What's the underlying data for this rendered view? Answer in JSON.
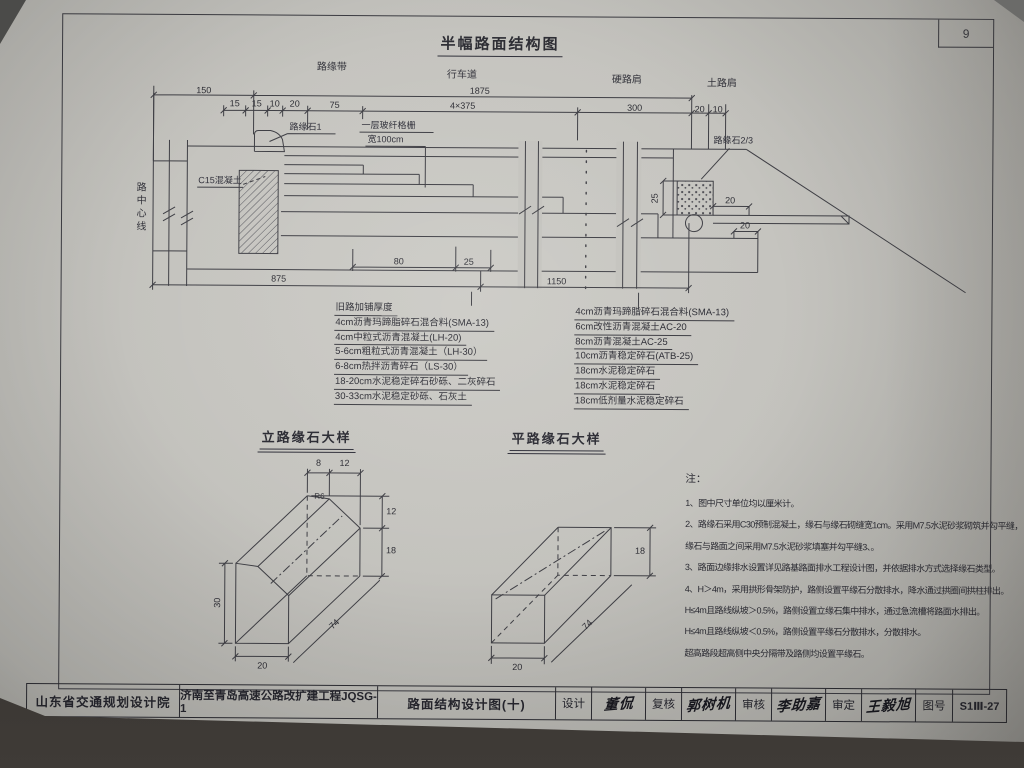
{
  "page": {
    "number": "9"
  },
  "drawing": {
    "title": "半幅路面结构图"
  },
  "cross_section": {
    "zone_labels": [
      "路缘带",
      "行车道",
      "硬路肩",
      "土路肩"
    ],
    "dims_top1": [
      "150",
      "1875"
    ],
    "dims_top2": [
      "15",
      "15",
      "10",
      "20",
      "75",
      "4×375",
      "300",
      "20",
      "10"
    ],
    "labels": {
      "curb1": "路缘石1",
      "geogrid1": "一层玻纤格栅",
      "geogrid2": "宽100cm",
      "concrete": "C15混凝土",
      "road_centerline": "路中心线",
      "curb23": "路缘石2/3"
    },
    "dims_inner": {
      "w80": "80",
      "w25": "25",
      "w875": "875",
      "w1150": "1150",
      "h25": "25",
      "w20_shoulder": "20",
      "w20_step": "20"
    }
  },
  "layer_lists": {
    "left": [
      "旧路加铺厚度",
      "4cm沥青玛蹄脂碎石混合料(SMA-13)",
      "4cm中粒式沥青混凝土(LH-20)",
      "5-6cm粗粒式沥青混凝土（LH-30）",
      "6-8cm热拌沥青碎石（LS-30）",
      "18-20cm水泥稳定碎石砂砾、二灰碎石",
      "30-33cm水泥稳定砂砾、石灰土"
    ],
    "right": [
      "4cm沥青玛蹄脂碎石混合料(SMA-13)",
      "6cm改性沥青混凝土AC-20",
      "8cm沥青混凝土AC-25",
      "10cm沥青稳定碎石(ATB-25)",
      "18cm水泥稳定碎石",
      "18cm水泥稳定碎石",
      "18cm低剂量水泥稳定碎石"
    ]
  },
  "details": {
    "vertical_curb": {
      "title": "立路缘石大样",
      "dims": {
        "top_a": "8",
        "top_b": "12",
        "right_upper": "12",
        "right_lower": "18",
        "height": "30",
        "width": "20",
        "length": "74",
        "fillet": "R6"
      }
    },
    "flat_curb": {
      "title": "平路缘石大样",
      "dims": {
        "height": "18",
        "width": "20",
        "length": "74"
      }
    }
  },
  "notes": {
    "heading": "注：",
    "lines": [
      "1、图中尺寸单位均以厘米计。",
      "2、路缘石采用C30预制混凝土，缘石与缘石砌缝宽1cm。采用M7.5水泥砂浆砌筑并勾平缝，",
      "缘石与路面之间采用M7.5水泥砂浆填塞并勾平缝3、。",
      "3、路面边缘排水设置详见路基路面排水工程设计图，并依据排水方式选择缘石类型。",
      "4、H＞4m，采用拱形骨架防护，路侧设置平缘石分散排水，降水通过拱圈间拱柱排出。",
      "H≤4m且路线纵坡＞0.5%，路侧设置立缘石集中排水，通过急流槽将路面水排出。",
      "H≤4m且路线纵坡＜0.5%，路侧设置平缘石分散排水，分散排水。",
      "超高路段超高侧中央分隔带及路侧均设置平缘石。"
    ]
  },
  "title_block": {
    "org": "山东省交通规划设计院",
    "project": "济南至青岛高速公路改扩建工程JQSG-1",
    "drawing_title": "路面结构设计图(十)",
    "roles": [
      {
        "label": "设计",
        "signature": "董侃"
      },
      {
        "label": "复核",
        "signature": "郭树机"
      },
      {
        "label": "审核",
        "signature": "李助嘉"
      },
      {
        "label": "审定",
        "signature": "王毅旭"
      }
    ],
    "sheet_no_label": "图号",
    "sheet_no": "S1Ⅲ-27"
  }
}
